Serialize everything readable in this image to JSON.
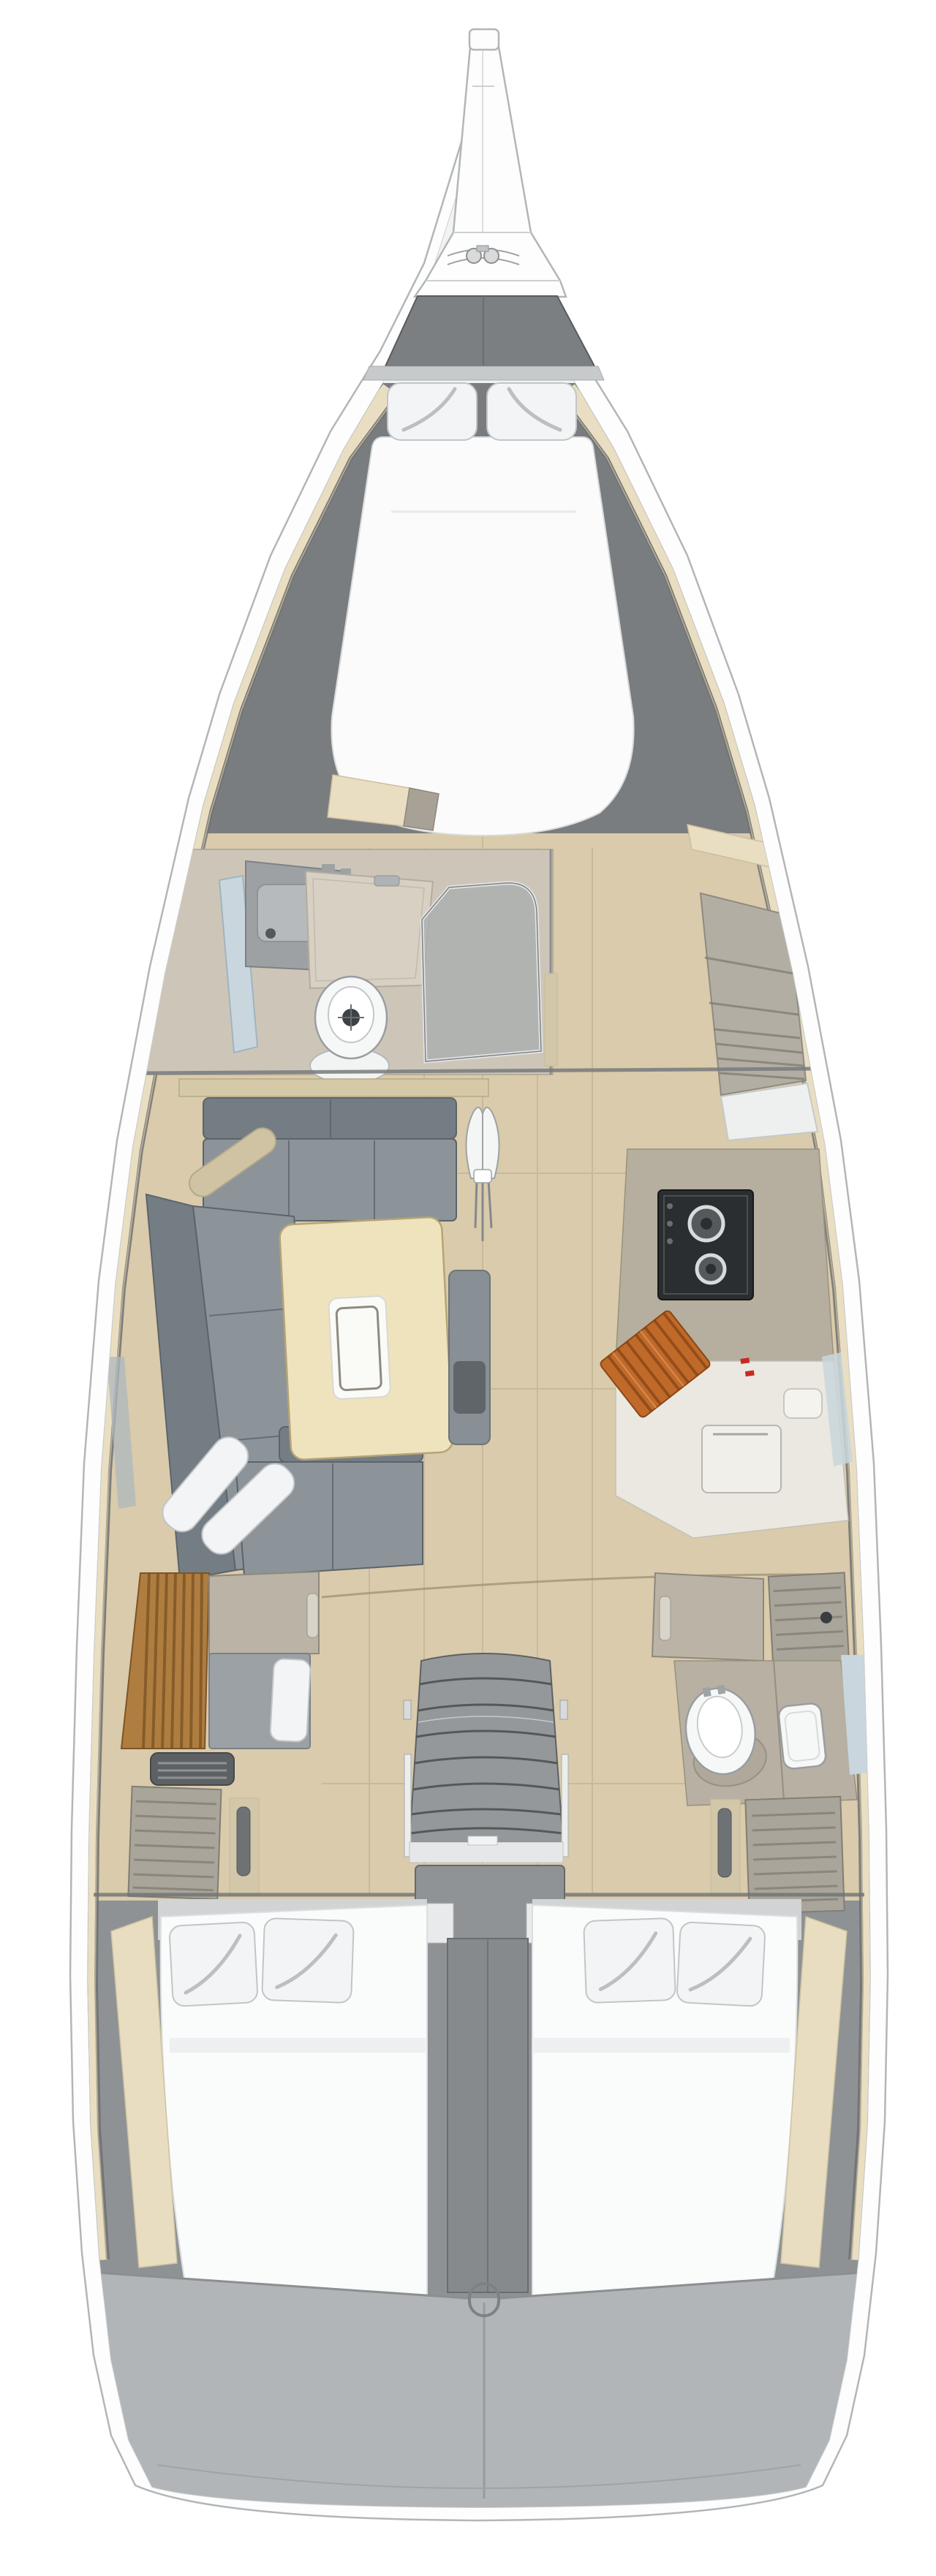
{
  "page": {
    "title": "Sailing yacht interior layout plan, top-down view, bow up",
    "background": "#ffffff"
  },
  "vessel": {
    "view": "overhead deck plan",
    "orientation": "bow-up",
    "regions": [
      {
        "id": "bowsprit",
        "label": "bowsprit and anchor fitting"
      },
      {
        "id": "foredeck-hatch",
        "label": "foredeck hatch"
      },
      {
        "id": "v-berth",
        "label": "forward cabin double berth with two pillows"
      },
      {
        "id": "forward-head",
        "label": "forward head with toilet, vanity and shower screen"
      },
      {
        "id": "forward-lockers",
        "label": "starboard shelved lockers"
      },
      {
        "id": "saloon",
        "label": "saloon with L-shaped settee and table"
      },
      {
        "id": "mast-foot",
        "label": "mast foot"
      },
      {
        "id": "galley",
        "label": "starboard galley with two-burner stove"
      },
      {
        "id": "companionway",
        "label": "companionway stairs"
      },
      {
        "id": "engine-box",
        "label": "engine compartment"
      },
      {
        "id": "aft-cabin-port",
        "label": "port aft cabin with teak slats and bench"
      },
      {
        "id": "aft-head-starboard",
        "label": "starboard aft head with toilet and sink"
      },
      {
        "id": "aft-berths",
        "label": "twin aft double berths with four pillows"
      },
      {
        "id": "transom",
        "label": "transom / swim platform"
      }
    ]
  },
  "colors": {
    "hull_fill": "#fdfdfd",
    "hull_line": "#b2b6b8",
    "deck_seam": "#cdd0d2",
    "liner_shadow": "#6e7173",
    "foredeck_white": "#f1f2f2",
    "hatch_gray": "#7b7f81",
    "hatch_edge": "#595c5e",
    "deck_band": "#c7cacb",
    "cabin_shadow": "#7a7d7f",
    "wood_floor": "#d9cbab",
    "wood_line": "#bdae8e",
    "trim_cream": "#e9dec2",
    "trim_edge": "#cdbf9e",
    "mattress": "#fbfbfb",
    "mattress_edge": "#d9dbdc",
    "pillow": "#f3f4f5",
    "pillow_edge": "#c2c5c7",
    "pillow_crease": "#9ea2a5",
    "sofa_seat": "#8d9499",
    "sofa_back": "#757d84",
    "sofa_edge": "#5c636a",
    "bolster_tan": "#cfc3a4",
    "table_wood": "#efe3bd",
    "table_edge": "#b5a476",
    "tray_white": "#fafaf7",
    "tray_inner": "#8f8a80",
    "seat_gray": "#899095",
    "galley_taupe": "#b6af9f",
    "counter_white": "#eae8e0",
    "counter_edge": "#b7b4a8",
    "stove_black": "#2b2e30",
    "burner_ring": "#d8dadb",
    "board_orange": "#c06a2a",
    "board_stripe": "#7e3f12",
    "accent_red": "#c82a22",
    "teak_slat": "#b07d41",
    "teak_dark": "#7c5423",
    "door_taupe": "#bab3a6",
    "door_edge": "#8e887c",
    "jamb_beige": "#d3c7a9",
    "handle_plate": "#6e7275",
    "louver_gray": "#a9a59b",
    "louver_line": "#827e74",
    "vent_dark": "#5d6164",
    "window_blue": "#c9d6dd",
    "steps_gray": "#94989b",
    "step_line": "#54585a",
    "engine_gray": "#8f9396",
    "column_gray": "#868a8d",
    "bed_white": "#fafbfb",
    "bedhead_gray": "#d2d3d4",
    "wall_beige": "#e8ddc0",
    "transom_gray": "#b1b5b7",
    "transom_line": "#8b8f91",
    "toilet_white": "#f6f7f7",
    "toilet_edge": "#9a9da0",
    "shower_glass": "#a9adaf",
    "shower_pan": "#d7d0c3",
    "vanity_gray": "#9da1a4",
    "head_floor": "#cdc6b8",
    "bulkhead": "#767a7c",
    "sill_beige": "#d6c9a8",
    "shelf_face": "#b3aea3"
  }
}
